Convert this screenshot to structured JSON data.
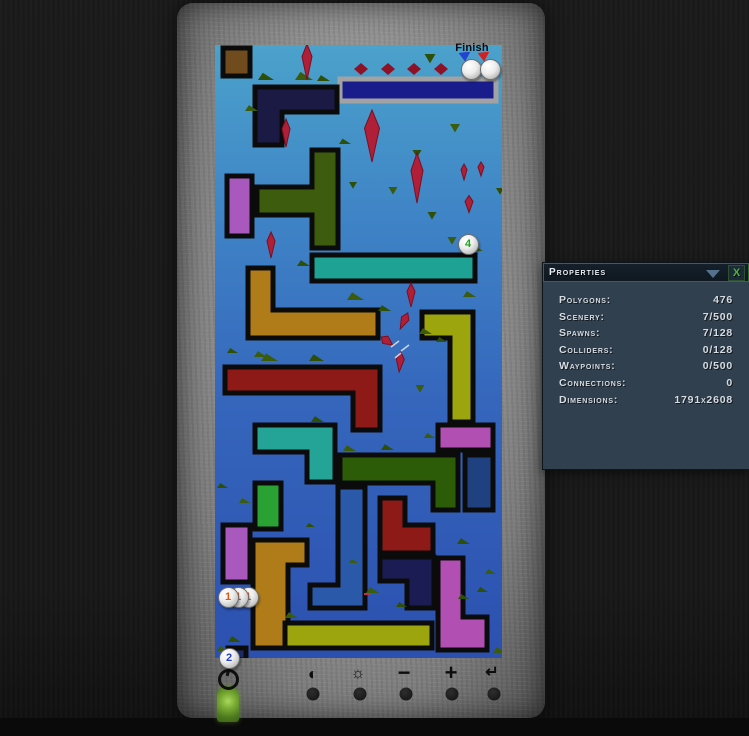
{
  "window": {
    "width": 749,
    "height": 736
  },
  "properties_panel": {
    "title": "Properties",
    "close_label": "X",
    "rows": [
      {
        "label": "Polygons:",
        "value": "476"
      },
      {
        "label": "Scenery:",
        "value": "7/500"
      },
      {
        "label": "Spawns:",
        "value": "7/128"
      },
      {
        "label": "Colliders:",
        "value": "0/128"
      },
      {
        "label": "Waypoints:",
        "value": "0/500"
      },
      {
        "label": "Connections:",
        "value": "0"
      },
      {
        "label": "Dimensions:",
        "value": "1791x2608"
      }
    ]
  },
  "level": {
    "finish_label": "Finish",
    "bg_top": "#4ba2cb",
    "bg_bottom": "#2c50b0",
    "finish_platform": {
      "color": "#191d8c",
      "border": "#a2a2a2",
      "points": [
        [
          125,
          34
        ],
        [
          281,
          34
        ],
        [
          281,
          56
        ],
        [
          125,
          56
        ]
      ]
    },
    "pieces": [
      {
        "name": "brown-square",
        "color": "#6f4b1d",
        "points": [
          [
            8,
            3
          ],
          [
            35,
            3
          ],
          [
            35,
            31
          ],
          [
            8,
            31
          ]
        ]
      },
      {
        "name": "navy-l",
        "color": "#1a1a45",
        "points": [
          [
            40,
            42
          ],
          [
            122,
            42
          ],
          [
            122,
            67
          ],
          [
            67,
            67
          ],
          [
            67,
            100
          ],
          [
            40,
            100
          ]
        ]
      },
      {
        "name": "purple-rect",
        "color": "#a958be",
        "points": [
          [
            12,
            131
          ],
          [
            37,
            131
          ],
          [
            37,
            191
          ],
          [
            12,
            191
          ]
        ]
      },
      {
        "name": "green-t",
        "color": "#3d5c0e",
        "points": [
          [
            97,
            105
          ],
          [
            123,
            105
          ],
          [
            123,
            203
          ],
          [
            97,
            203
          ],
          [
            97,
            170
          ],
          [
            42,
            170
          ],
          [
            42,
            142
          ],
          [
            97,
            142
          ]
        ]
      },
      {
        "name": "teal-bar",
        "color": "#1da293",
        "points": [
          [
            97,
            210
          ],
          [
            260,
            210
          ],
          [
            260,
            236
          ],
          [
            97,
            236
          ]
        ]
      },
      {
        "name": "ochre-l",
        "color": "#b07c1a",
        "points": [
          [
            33,
            223
          ],
          [
            58,
            223
          ],
          [
            58,
            265
          ],
          [
            163,
            265
          ],
          [
            163,
            293
          ],
          [
            33,
            293
          ]
        ]
      },
      {
        "name": "maroon-l",
        "color": "#8e1a18",
        "points": [
          [
            10,
            322
          ],
          [
            165,
            322
          ],
          [
            165,
            385
          ],
          [
            138,
            385
          ],
          [
            138,
            348
          ],
          [
            10,
            348
          ]
        ]
      },
      {
        "name": "olive-l-right",
        "color": "#9da50e",
        "points": [
          [
            207,
            267
          ],
          [
            258,
            267
          ],
          [
            258,
            377
          ],
          [
            235,
            377
          ],
          [
            235,
            293
          ],
          [
            207,
            293
          ]
        ]
      },
      {
        "name": "teal-l2",
        "color": "#24a496",
        "points": [
          [
            40,
            380
          ],
          [
            120,
            380
          ],
          [
            120,
            437
          ],
          [
            92,
            437
          ],
          [
            92,
            407
          ],
          [
            40,
            407
          ]
        ]
      },
      {
        "name": "magenta-bar",
        "color": "#b150b2",
        "points": [
          [
            223,
            380
          ],
          [
            278,
            380
          ],
          [
            278,
            405
          ],
          [
            223,
            405
          ]
        ]
      },
      {
        "name": "darkgreen-l",
        "color": "#2d5c08",
        "points": [
          [
            125,
            410
          ],
          [
            243,
            410
          ],
          [
            243,
            465
          ],
          [
            218,
            465
          ],
          [
            218,
            438
          ],
          [
            125,
            438
          ]
        ]
      },
      {
        "name": "navy-vert",
        "color": "#20417f",
        "points": [
          [
            250,
            410
          ],
          [
            278,
            410
          ],
          [
            278,
            465
          ],
          [
            250,
            465
          ]
        ]
      },
      {
        "name": "green-vert",
        "color": "#2aa233",
        "points": [
          [
            40,
            438
          ],
          [
            66,
            438
          ],
          [
            66,
            484
          ],
          [
            40,
            484
          ]
        ]
      },
      {
        "name": "purple-vert",
        "color": "#a958be",
        "points": [
          [
            8,
            480
          ],
          [
            35,
            480
          ],
          [
            35,
            537
          ],
          [
            8,
            537
          ]
        ]
      },
      {
        "name": "ochre-gamma",
        "color": "#b07c1a",
        "points": [
          [
            38,
            495
          ],
          [
            92,
            495
          ],
          [
            92,
            520
          ],
          [
            73,
            520
          ],
          [
            73,
            603
          ],
          [
            38,
            603
          ]
        ]
      },
      {
        "name": "blue-j",
        "color": "#2b59a9",
        "points": [
          [
            123,
            442
          ],
          [
            150,
            442
          ],
          [
            150,
            563
          ],
          [
            95,
            563
          ],
          [
            95,
            540
          ],
          [
            123,
            540
          ]
        ]
      },
      {
        "name": "maroon-step",
        "color": "#8e1a18",
        "points": [
          [
            165,
            453
          ],
          [
            190,
            453
          ],
          [
            190,
            480
          ],
          [
            218,
            480
          ],
          [
            218,
            508
          ],
          [
            165,
            508
          ]
        ]
      },
      {
        "name": "navy-l2",
        "color": "#1c1c55",
        "points": [
          [
            165,
            512
          ],
          [
            219,
            512
          ],
          [
            219,
            563
          ],
          [
            192,
            563
          ],
          [
            192,
            536
          ],
          [
            165,
            536
          ]
        ]
      },
      {
        "name": "purple-j",
        "color": "#b150b2",
        "points": [
          [
            223,
            513
          ],
          [
            248,
            513
          ],
          [
            248,
            572
          ],
          [
            272,
            572
          ],
          [
            272,
            605
          ],
          [
            223,
            605
          ]
        ]
      },
      {
        "name": "olive-bar",
        "color": "#9da50e",
        "points": [
          [
            70,
            578
          ],
          [
            217,
            578
          ],
          [
            217,
            603
          ],
          [
            70,
            603
          ]
        ]
      },
      {
        "name": "navy-square",
        "color": "#1c2c68",
        "points": [
          [
            13,
            603
          ],
          [
            31,
            603
          ],
          [
            31,
            615
          ],
          [
            13,
            615
          ]
        ]
      }
    ],
    "crystals": [
      {
        "x": 92,
        "y": 17,
        "w": 10,
        "h": 36,
        "r": 0
      },
      {
        "x": 71,
        "y": 88,
        "w": 8,
        "h": 28,
        "r": 0
      },
      {
        "x": 157,
        "y": 91,
        "w": 15,
        "h": 52,
        "r": 0
      },
      {
        "x": 202,
        "y": 133,
        "w": 12,
        "h": 50,
        "r": 0
      },
      {
        "x": 249,
        "y": 127,
        "w": 6,
        "h": 16,
        "r": 0
      },
      {
        "x": 266,
        "y": 124,
        "w": 6,
        "h": 14,
        "r": 0
      },
      {
        "x": 254,
        "y": 159,
        "w": 8,
        "h": 17,
        "r": 0
      },
      {
        "x": 56,
        "y": 200,
        "w": 8,
        "h": 26,
        "r": 0
      },
      {
        "x": 196,
        "y": 250,
        "w": 8,
        "h": 24,
        "r": 0
      },
      {
        "x": 189,
        "y": 276,
        "w": 8,
        "h": 18,
        "r": 25
      },
      {
        "x": 172,
        "y": 296,
        "w": 9,
        "h": 14,
        "r": -55
      },
      {
        "x": 185,
        "y": 317,
        "w": 8,
        "h": 20,
        "r": 5
      }
    ],
    "scenery": [
      {
        "t": "ramp",
        "x": 43,
        "y": 35,
        "s": 16
      },
      {
        "t": "ramp",
        "x": 80,
        "y": 35,
        "s": 18
      },
      {
        "t": "ramp",
        "x": 102,
        "y": 36,
        "s": 13
      },
      {
        "t": "ramp",
        "x": 30,
        "y": 66,
        "s": 13
      },
      {
        "t": "ramp",
        "x": 124,
        "y": 99,
        "s": 12
      },
      {
        "t": "ramp",
        "x": 252,
        "y": 206,
        "s": 16
      },
      {
        "t": "ramp",
        "x": 82,
        "y": 221,
        "s": 13
      },
      {
        "t": "ramp",
        "x": 46,
        "y": 316,
        "s": 17
      },
      {
        "t": "ramp",
        "x": 12,
        "y": 308,
        "s": 11
      },
      {
        "t": "ramp",
        "x": 39,
        "y": 312,
        "s": 13
      },
      {
        "t": "ramp",
        "x": 94,
        "y": 316,
        "s": 15
      },
      {
        "t": "ramp",
        "x": 132,
        "y": 255,
        "s": 17
      },
      {
        "t": "ramp",
        "x": 163,
        "y": 266,
        "s": 13
      },
      {
        "t": "ramp",
        "x": 204,
        "y": 289,
        "s": 13
      },
      {
        "t": "ramp",
        "x": 221,
        "y": 297,
        "s": 11
      },
      {
        "t": "ramp",
        "x": 248,
        "y": 252,
        "s": 13
      },
      {
        "t": "ramp",
        "x": 96,
        "y": 377,
        "s": 13
      },
      {
        "t": "ramp",
        "x": 128,
        "y": 406,
        "s": 13
      },
      {
        "t": "ramp",
        "x": 166,
        "y": 405,
        "s": 13
      },
      {
        "t": "ramp",
        "x": 209,
        "y": 393,
        "s": 11
      },
      {
        "t": "ramp",
        "x": 2,
        "y": 443,
        "s": 11
      },
      {
        "t": "ramp",
        "x": 24,
        "y": 458,
        "s": 11
      },
      {
        "t": "ramp",
        "x": 91,
        "y": 482,
        "s": 9
      },
      {
        "t": "ramp",
        "x": 134,
        "y": 518,
        "s": 9
      },
      {
        "t": "ramp",
        "x": 242,
        "y": 499,
        "s": 13
      },
      {
        "t": "ramp",
        "x": 270,
        "y": 529,
        "s": 11
      },
      {
        "t": "ramp",
        "x": 262,
        "y": 547,
        "s": 11
      },
      {
        "t": "ramp",
        "x": 151,
        "y": 548,
        "s": 13
      },
      {
        "t": "ramp",
        "x": 181,
        "y": 562,
        "s": 11
      },
      {
        "t": "ramp",
        "x": 70,
        "y": 573,
        "s": 13
      },
      {
        "t": "ramp",
        "x": 13,
        "y": 597,
        "s": 13
      },
      {
        "t": "ramp",
        "x": 2,
        "y": 606,
        "s": 11
      },
      {
        "t": "ramp",
        "x": 243,
        "y": 554,
        "s": 11
      },
      {
        "t": "ramp",
        "x": 278,
        "y": 608,
        "s": 13
      },
      {
        "t": "tri",
        "x": 215,
        "y": 9,
        "s": 11
      },
      {
        "t": "tri",
        "x": 240,
        "y": 79,
        "s": 10
      },
      {
        "t": "tri",
        "x": 202,
        "y": 105,
        "s": 9
      },
      {
        "t": "tri",
        "x": 178,
        "y": 142,
        "s": 9
      },
      {
        "t": "tri",
        "x": 217,
        "y": 167,
        "s": 9
      },
      {
        "t": "tri",
        "x": 237,
        "y": 192,
        "s": 9
      },
      {
        "t": "tri",
        "x": 138,
        "y": 137,
        "s": 8
      },
      {
        "t": "tri",
        "x": 205,
        "y": 340,
        "s": 9
      },
      {
        "t": "tri",
        "x": 285,
        "y": 143,
        "s": 8
      }
    ],
    "finish_diamonds": [
      {
        "x": 146,
        "y": 24
      },
      {
        "x": 173,
        "y": 24
      },
      {
        "x": 199,
        "y": 24
      },
      {
        "x": 226,
        "y": 24
      },
      {
        "x": 253,
        "y": 24
      }
    ],
    "sparkles": [
      [
        176,
        302,
        184,
        296
      ],
      [
        186,
        306,
        194,
        300
      ],
      [
        180,
        313,
        186,
        308
      ]
    ],
    "colors": {
      "grass": "#3a5c0c",
      "grass2": "#2e4f08",
      "crystal": "#b01f38",
      "crystal_edge": "#7a0e20",
      "diamond": "#8e1126"
    },
    "markers": [
      {
        "label": "1",
        "color": "#e25512",
        "cx": 247,
        "cy": 596
      },
      {
        "label": "1",
        "color": "#e25512",
        "cx": 237,
        "cy": 596
      },
      {
        "label": "1",
        "color": "#e25512",
        "cx": 227,
        "cy": 596
      },
      {
        "label": "2",
        "color": "#2340cf",
        "cx": 228,
        "cy": 657
      },
      {
        "label": "4",
        "color": "#1fa41f",
        "cx": 467,
        "cy": 243
      }
    ],
    "flags": [
      {
        "name": "start-flag",
        "color": "#2244d0",
        "cx": 470,
        "cy": 68
      },
      {
        "name": "finish-flag",
        "color": "#d02222",
        "cx": 489,
        "cy": 68
      }
    ]
  },
  "toolbar": {
    "icons": [
      {
        "name": "contrast-icon",
        "glyph": "◐",
        "x": 313,
        "y": 674,
        "size": 17
      },
      {
        "name": "brightness-icon",
        "glyph": "☼",
        "x": 358,
        "y": 674,
        "size": 16
      },
      {
        "name": "zoom-out-icon",
        "glyph": "−",
        "x": 404,
        "y": 673,
        "size": 22
      },
      {
        "name": "zoom-in-icon",
        "glyph": "+",
        "x": 451,
        "y": 673,
        "size": 22
      },
      {
        "name": "return-icon",
        "glyph": "↵",
        "x": 492,
        "y": 673,
        "size": 16
      }
    ],
    "knobs": [
      313,
      360,
      406,
      452,
      494
    ],
    "knob_y": 694
  }
}
